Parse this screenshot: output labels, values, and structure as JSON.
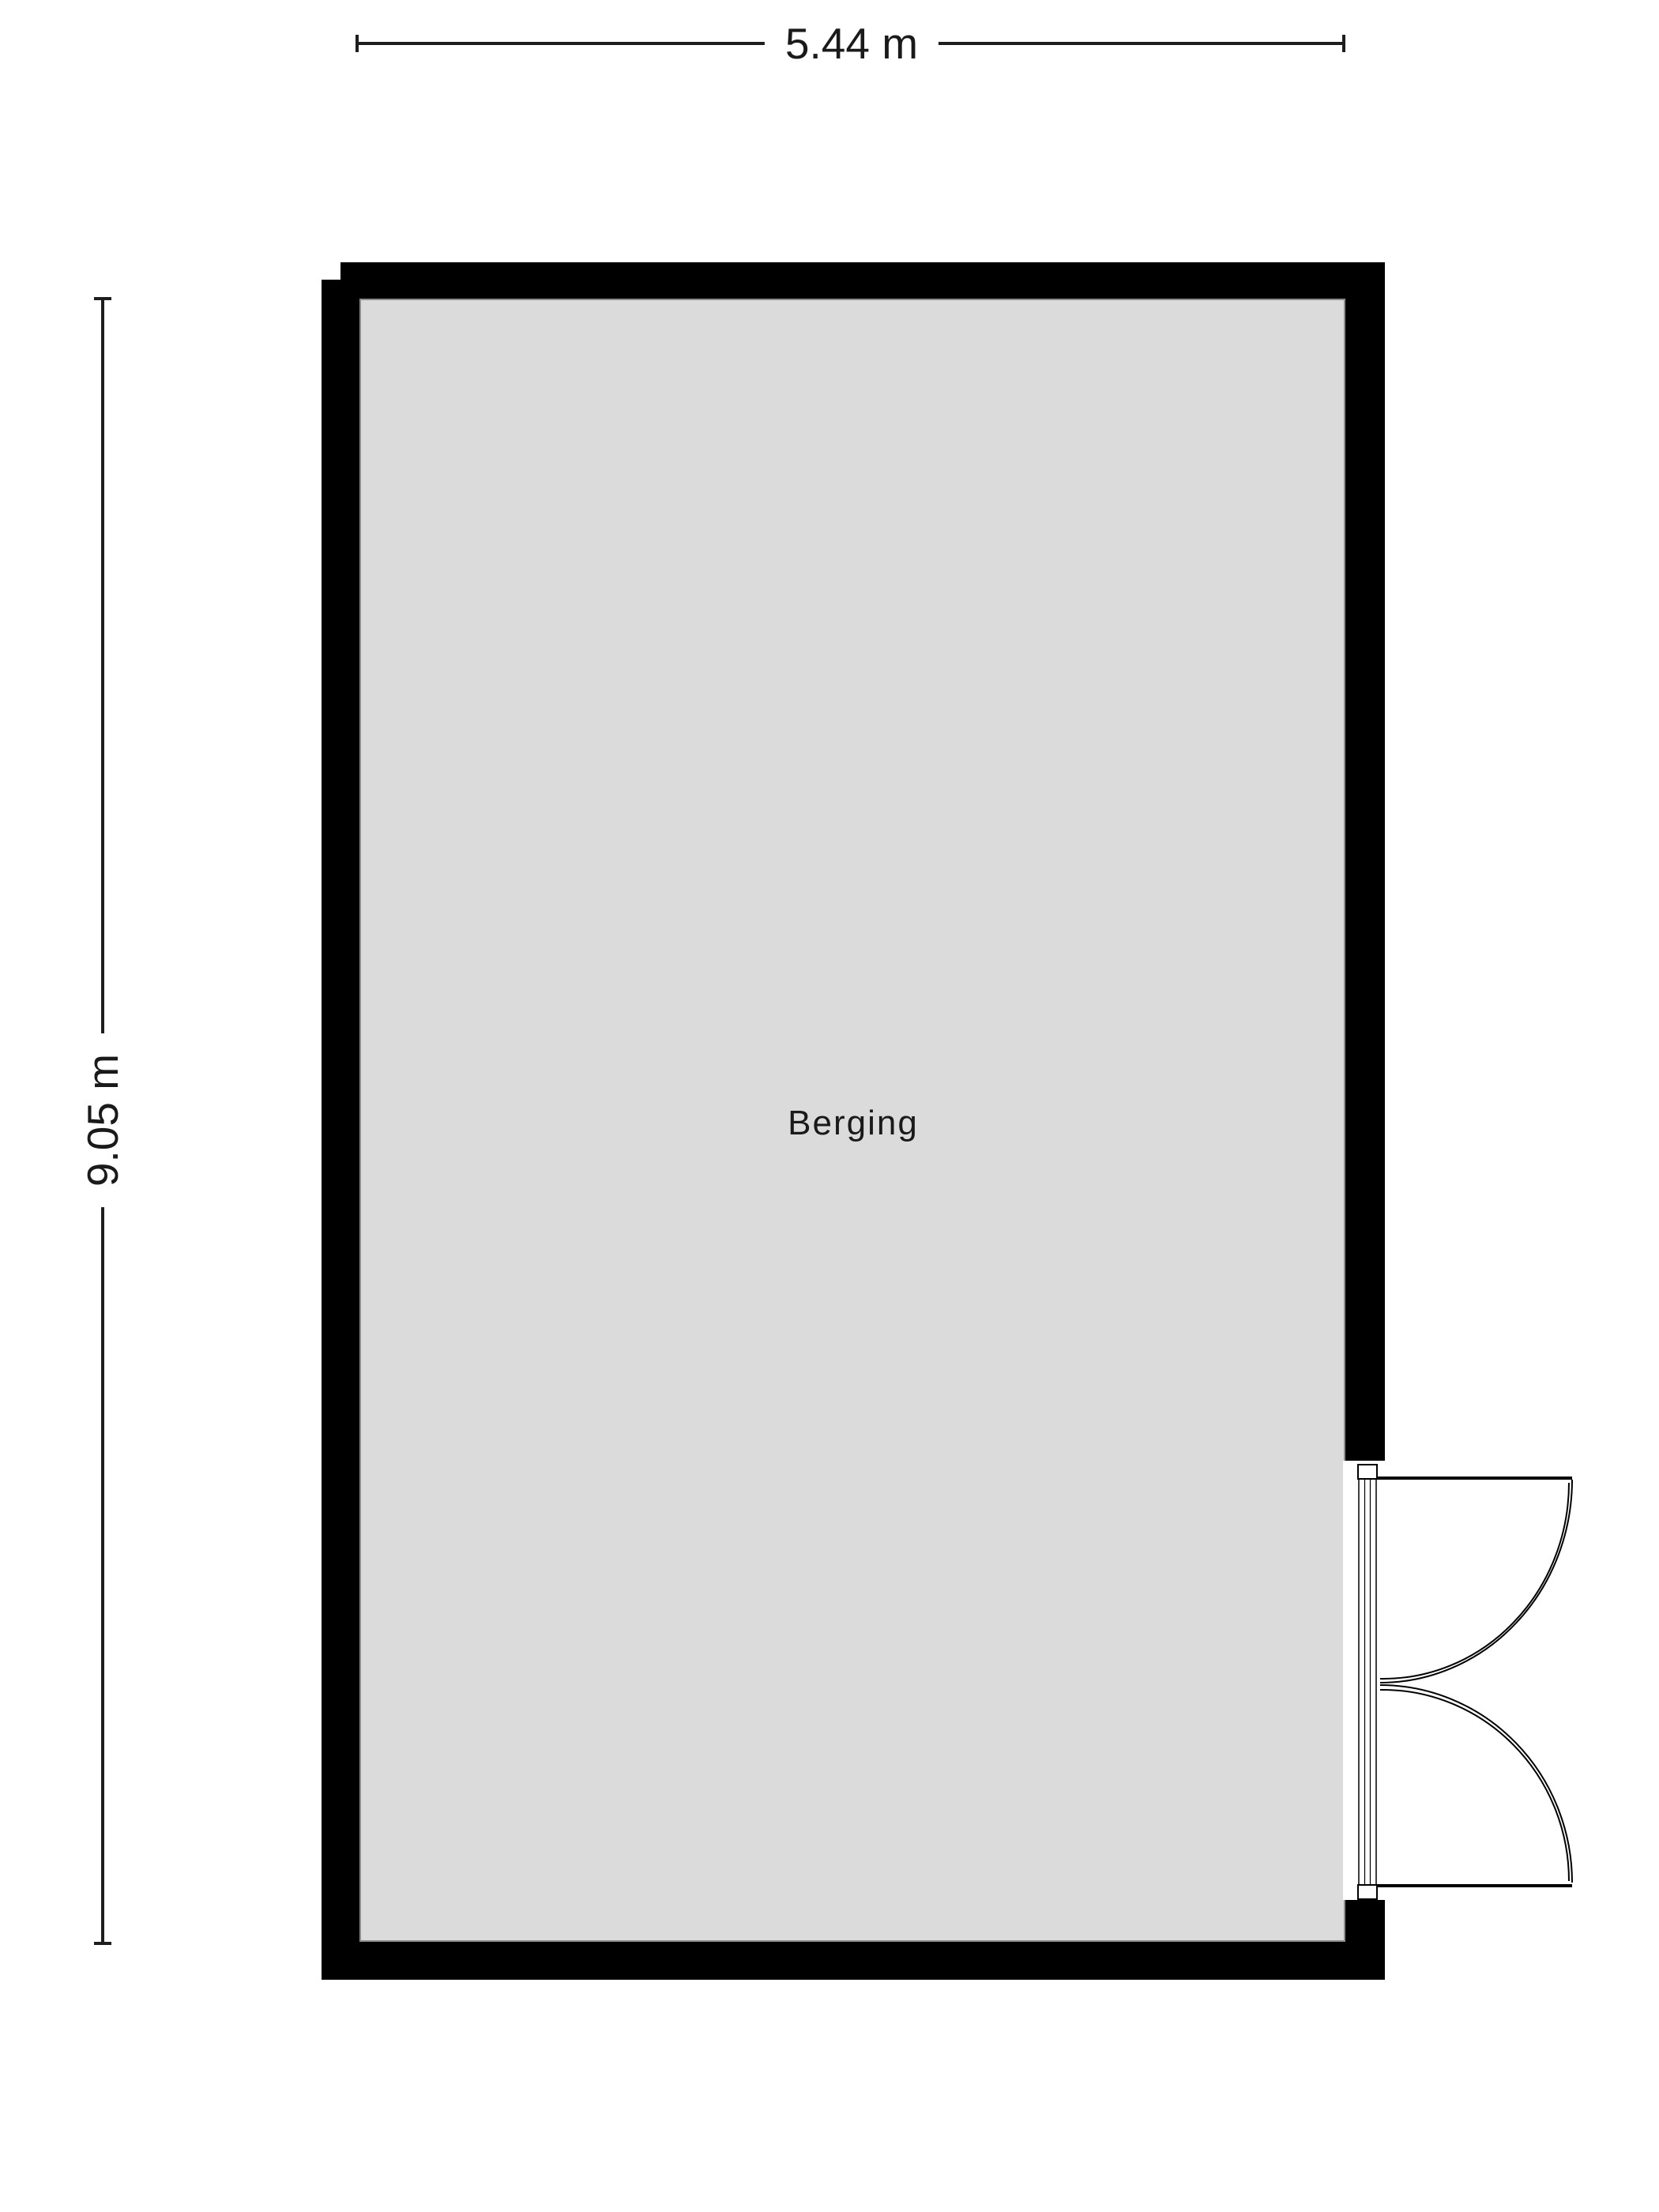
{
  "plan": {
    "type": "floor-plan",
    "room": {
      "label": "Berging"
    },
    "dimensions": {
      "width_label": "5.44 m",
      "height_label": "9.05 m"
    },
    "features": [
      "double-door"
    ]
  },
  "colors": {
    "wall": "#000000",
    "floor": "#dbdbdb",
    "floor_border": "#8d8d8d",
    "line": "#1e1e1e",
    "text": "#1a1a1a",
    "background": "#ffffff"
  }
}
